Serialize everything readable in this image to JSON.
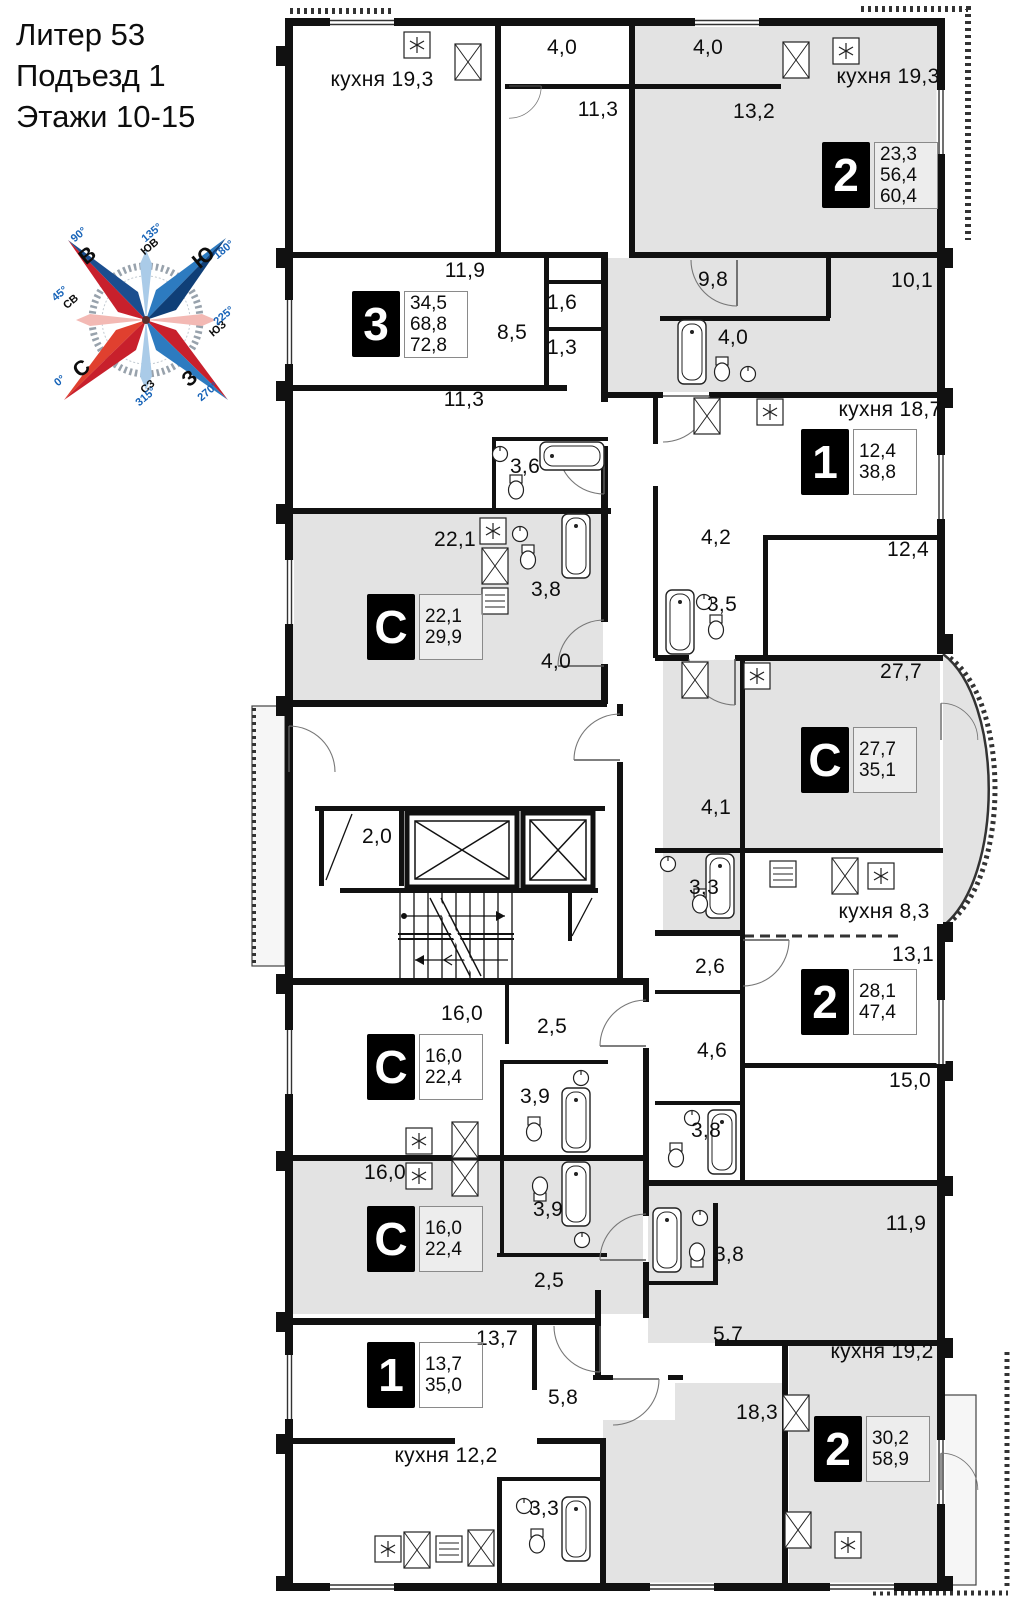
{
  "header": {
    "lines": [
      "Литер 53",
      "Подъезд 1",
      "Этажи 10-15"
    ]
  },
  "colors": {
    "wall": "#111111",
    "room_fill": "#e3e3e3",
    "accent_red": "#c8202c",
    "accent_blue": "#1b4e8f"
  },
  "compass": {
    "labels": [
      {
        "text": "В",
        "x": 88,
        "y": 256,
        "cls": "c-dir"
      },
      {
        "text": "Ю",
        "x": 204,
        "y": 258,
        "cls": "c-dir"
      },
      {
        "text": "С",
        "x": 82,
        "y": 369,
        "cls": "c-dir"
      },
      {
        "text": "З",
        "x": 190,
        "y": 379,
        "cls": "c-dir"
      },
      {
        "text": "СВ",
        "x": 71,
        "y": 302,
        "cls": "c-sub"
      },
      {
        "text": "ЮВ",
        "x": 150,
        "y": 247,
        "cls": "c-sub"
      },
      {
        "text": "ЮЗ",
        "x": 218,
        "y": 329,
        "cls": "c-sub"
      },
      {
        "text": "СЗ",
        "x": 148,
        "y": 387,
        "cls": "c-sub"
      },
      {
        "text": "90°",
        "x": 79,
        "y": 235,
        "cls": "c-deg"
      },
      {
        "text": "180°",
        "x": 224,
        "y": 250,
        "cls": "c-deg"
      },
      {
        "text": "0°",
        "x": 60,
        "y": 381,
        "cls": "c-deg"
      },
      {
        "text": "270°",
        "x": 208,
        "y": 392,
        "cls": "c-deg"
      },
      {
        "text": "45°",
        "x": 60,
        "y": 294,
        "cls": "c-deg"
      },
      {
        "text": "135°",
        "x": 152,
        "y": 233,
        "cls": "c-deg"
      },
      {
        "text": "225°",
        "x": 224,
        "y": 316,
        "cls": "c-deg"
      },
      {
        "text": "315°",
        "x": 146,
        "y": 397,
        "cls": "c-deg"
      }
    ]
  },
  "plan": {
    "room_labels": [
      {
        "text": "кухня 19,3",
        "x": 382,
        "y": 80
      },
      {
        "text": "4,0",
        "x": 562,
        "y": 48
      },
      {
        "text": "11,3",
        "x": 598,
        "y": 110
      },
      {
        "text": "4,0",
        "x": 708,
        "y": 48
      },
      {
        "text": "13,2",
        "x": 754,
        "y": 112
      },
      {
        "text": "кухня 19,3",
        "x": 888,
        "y": 77
      },
      {
        "text": "11,9",
        "x": 465,
        "y": 271
      },
      {
        "text": "8,5",
        "x": 512,
        "y": 333
      },
      {
        "text": "1,6",
        "x": 562,
        "y": 303
      },
      {
        "text": "1,3",
        "x": 562,
        "y": 348
      },
      {
        "text": "11,3",
        "x": 464,
        "y": 400
      },
      {
        "text": "3,6",
        "x": 525,
        "y": 467
      },
      {
        "text": "9,8",
        "x": 713,
        "y": 280
      },
      {
        "text": "10,1",
        "x": 912,
        "y": 281
      },
      {
        "text": "4,0",
        "x": 733,
        "y": 338
      },
      {
        "text": "кухня 18,7",
        "x": 890,
        "y": 410
      },
      {
        "text": "4,2",
        "x": 716,
        "y": 538
      },
      {
        "text": "12,4",
        "x": 908,
        "y": 550
      },
      {
        "text": "3,5",
        "x": 722,
        "y": 605
      },
      {
        "text": "22,1",
        "x": 455,
        "y": 540
      },
      {
        "text": "3,8",
        "x": 546,
        "y": 590
      },
      {
        "text": "4,0",
        "x": 556,
        "y": 662
      },
      {
        "text": "27,7",
        "x": 901,
        "y": 672
      },
      {
        "text": "4,1",
        "x": 716,
        "y": 808
      },
      {
        "text": "3,3",
        "x": 704,
        "y": 888
      },
      {
        "text": "кухня 8,3",
        "x": 884,
        "y": 912
      },
      {
        "text": "2,0",
        "x": 377,
        "y": 837
      },
      {
        "text": "2,6",
        "x": 710,
        "y": 967
      },
      {
        "text": "13,1",
        "x": 913,
        "y": 955
      },
      {
        "text": "16,0",
        "x": 462,
        "y": 1014
      },
      {
        "text": "2,5",
        "x": 552,
        "y": 1027
      },
      {
        "text": "3,9",
        "x": 535,
        "y": 1097
      },
      {
        "text": "4,6",
        "x": 712,
        "y": 1051
      },
      {
        "text": "15,0",
        "x": 910,
        "y": 1081
      },
      {
        "text": "3,8",
        "x": 706,
        "y": 1131
      },
      {
        "text": "16,0",
        "x": 385,
        "y": 1173
      },
      {
        "text": "3,9",
        "x": 548,
        "y": 1210
      },
      {
        "text": "2,5",
        "x": 549,
        "y": 1281
      },
      {
        "text": "3,8",
        "x": 729,
        "y": 1255
      },
      {
        "text": "11,9",
        "x": 906,
        "y": 1224
      },
      {
        "text": "13,7",
        "x": 497,
        "y": 1339
      },
      {
        "text": "5,8",
        "x": 563,
        "y": 1398
      },
      {
        "text": "5,7",
        "x": 728,
        "y": 1335
      },
      {
        "text": "кухня 19,2",
        "x": 882,
        "y": 1352
      },
      {
        "text": "18,3",
        "x": 757,
        "y": 1413
      },
      {
        "text": "кухня 12,2",
        "x": 446,
        "y": 1456
      },
      {
        "text": "3,3",
        "x": 544,
        "y": 1509
      }
    ],
    "apartments": [
      {
        "char": "2",
        "nums": [
          "23,3",
          "56,4",
          "60,4"
        ],
        "x": 822,
        "y": 142
      },
      {
        "char": "3",
        "nums": [
          "34,5",
          "68,8",
          "72,8"
        ],
        "x": 352,
        "y": 291
      },
      {
        "char": "1",
        "nums": [
          "12,4",
          "38,8"
        ],
        "x": 801,
        "y": 429
      },
      {
        "char": "С",
        "nums": [
          "22,1",
          "29,9"
        ],
        "x": 367,
        "y": 594
      },
      {
        "char": "С",
        "nums": [
          "27,7",
          "35,1"
        ],
        "x": 801,
        "y": 727
      },
      {
        "char": "2",
        "nums": [
          "28,1",
          "47,4"
        ],
        "x": 801,
        "y": 969
      },
      {
        "char": "С",
        "nums": [
          "16,0",
          "22,4"
        ],
        "x": 367,
        "y": 1034
      },
      {
        "char": "С",
        "nums": [
          "16,0",
          "22,4"
        ],
        "x": 367,
        "y": 1206
      },
      {
        "char": "1",
        "nums": [
          "13,7",
          "35,0"
        ],
        "x": 367,
        "y": 1342
      },
      {
        "char": "2",
        "nums": [
          "30,2",
          "58,9"
        ],
        "x": 814,
        "y": 1416
      }
    ]
  }
}
